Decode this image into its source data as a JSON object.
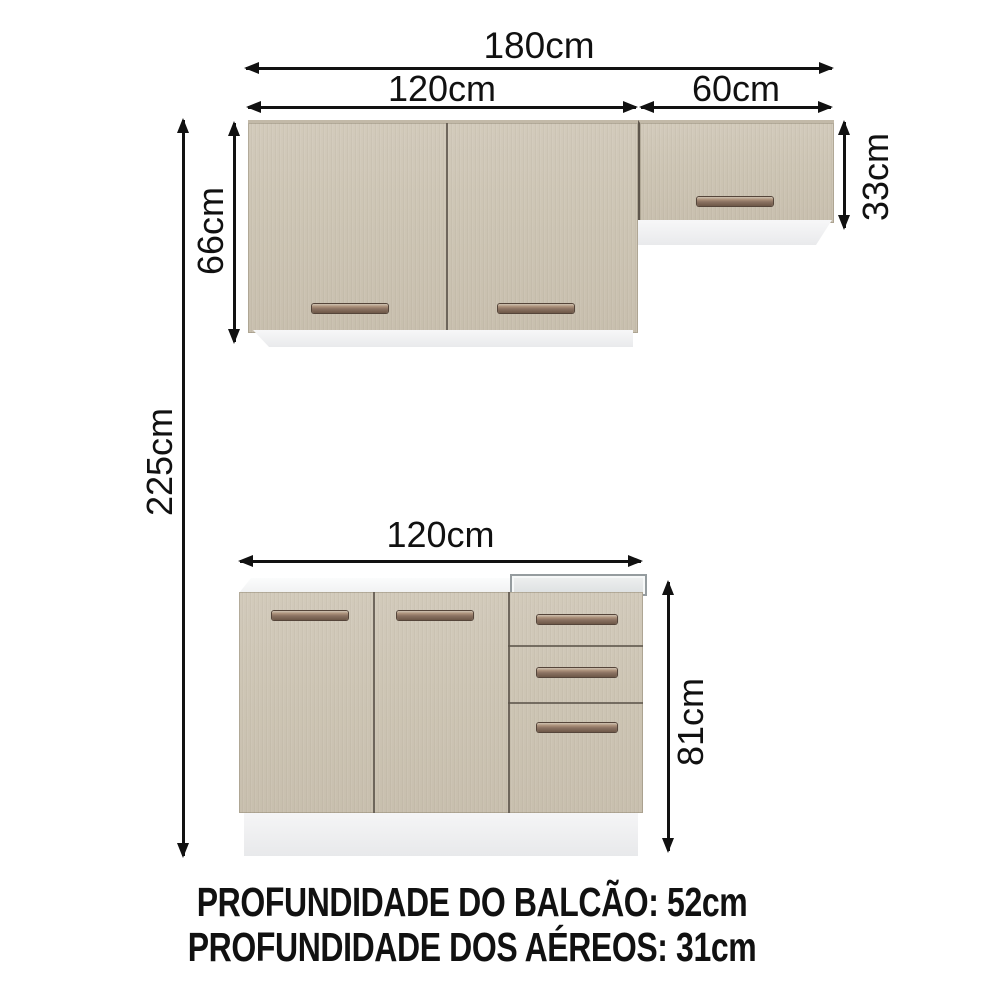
{
  "diagram": {
    "dims": {
      "total_width": "180cm",
      "upper_left_width": "120cm",
      "upper_right_width": "60cm",
      "upper_left_height": "66cm",
      "upper_right_height": "33cm",
      "total_height": "225cm",
      "base_width": "120cm",
      "base_height": "81cm"
    },
    "footer": {
      "line1": "PROFUNDIDADE DO BALCÃO: 52cm",
      "line2": "PROFUNDIDADE DOS AÉREOS: 31cm"
    },
    "colors": {
      "background": "#ffffff",
      "cabinet": "#cdc5b4",
      "cabinet_edge": "#c2b9a8",
      "divider": "#5e564c",
      "handle": "#8a7161",
      "arrow": "#111111"
    }
  }
}
